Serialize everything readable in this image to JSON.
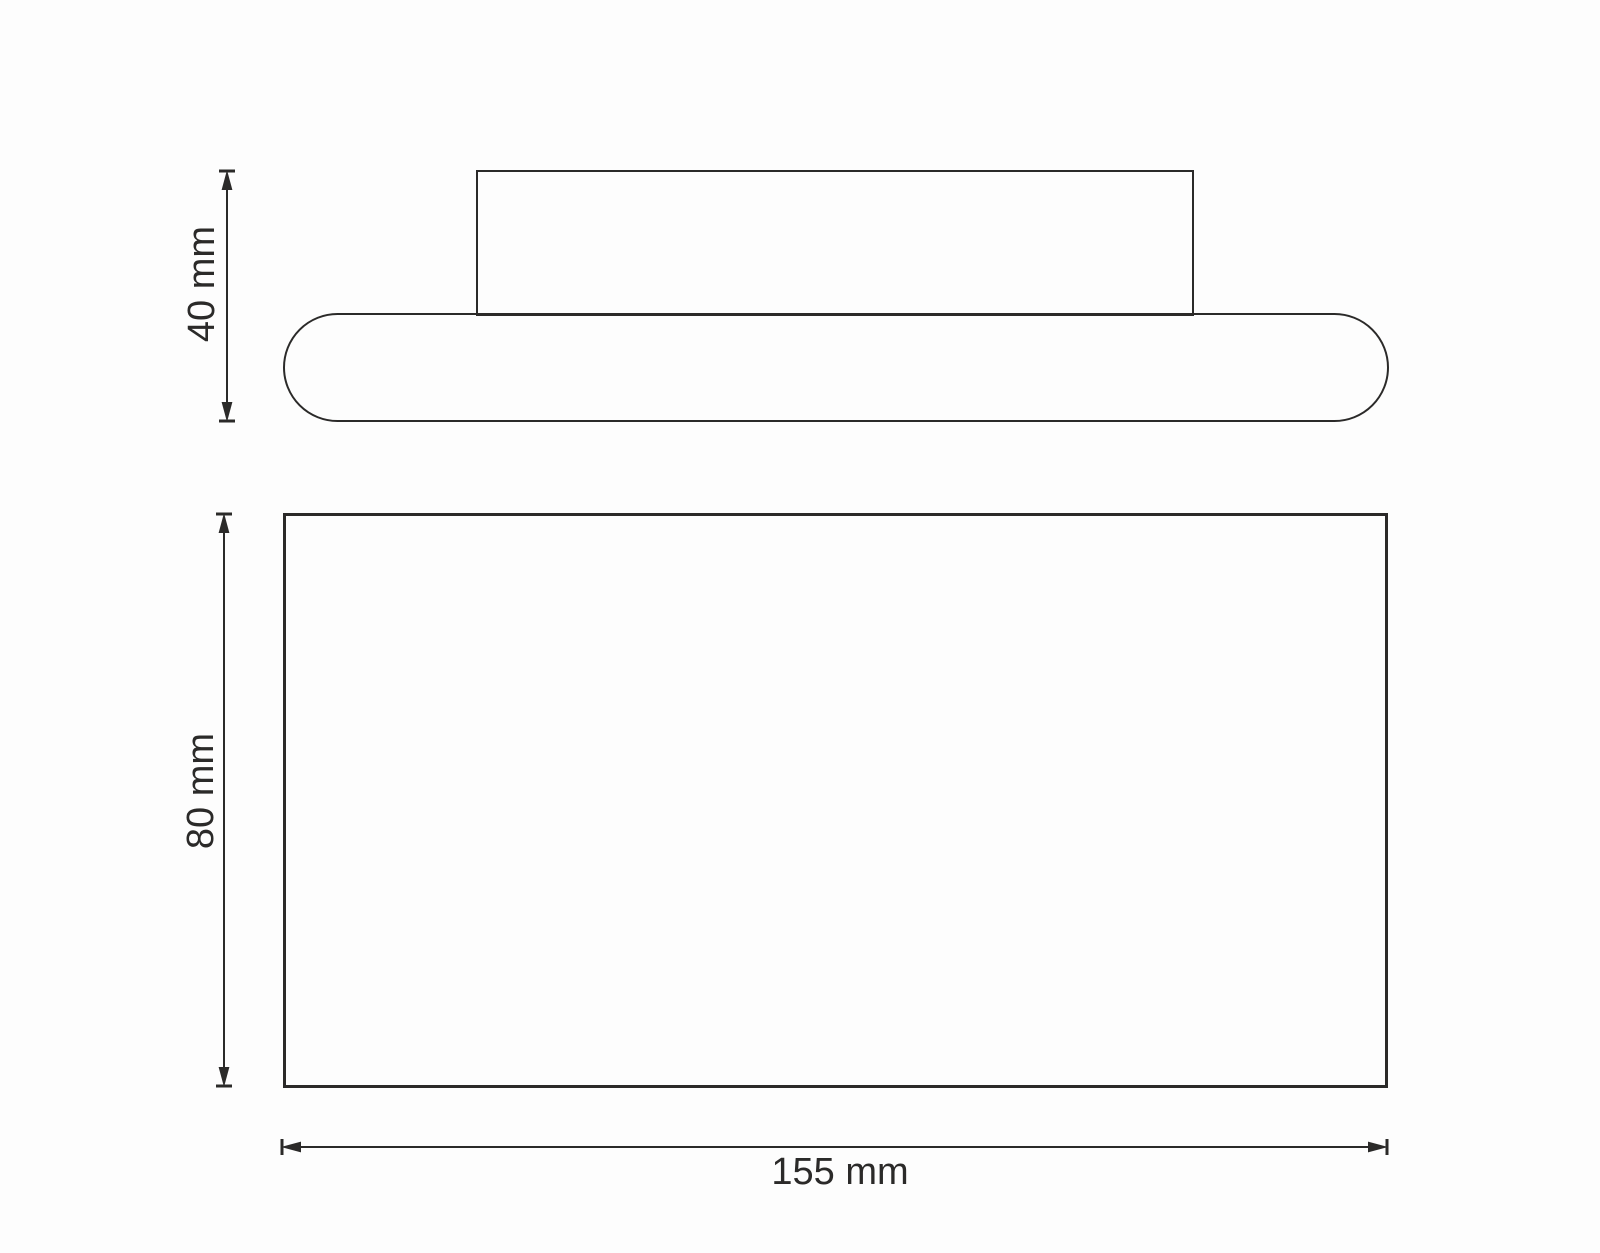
{
  "colors": {
    "line": "#2b2a29",
    "background": "#fdfdfd"
  },
  "dimensions": {
    "side_height": {
      "label": "40 mm"
    },
    "front_height": {
      "label": "80 mm"
    },
    "front_width": {
      "label": "155 mm"
    }
  }
}
